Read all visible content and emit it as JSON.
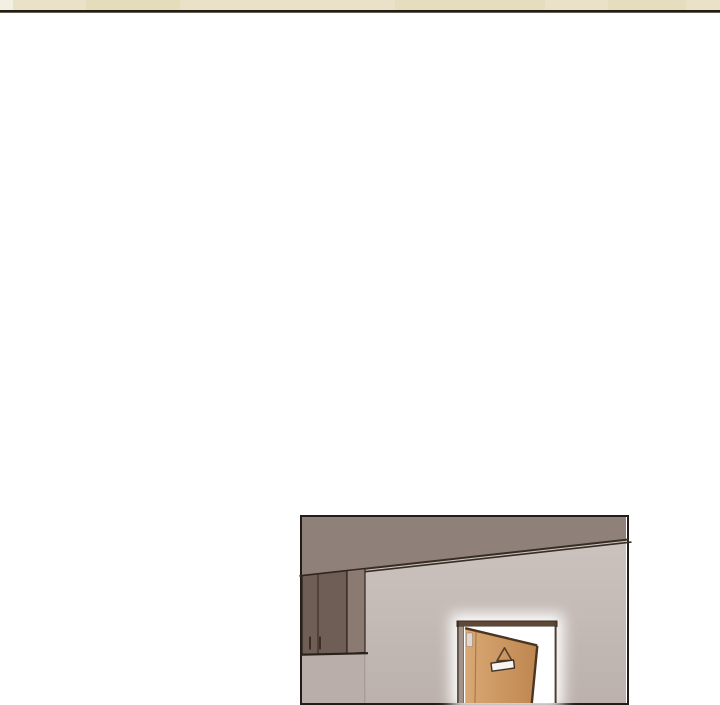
{
  "page": {
    "background": "#ffffff"
  },
  "top_strip": {
    "cream": "#e9e2c8",
    "cream_light": "#f2efe3",
    "beige_patch": "#e2d7b2",
    "edge_line": "#241b11"
  },
  "panel": {
    "border": "#231c18",
    "wall_top": "#cdc5c1",
    "wall_bottom": "#bcb1ac",
    "side_wall": "#b9aeaa",
    "ceiling": "#8f807a",
    "trim_line": "#382d24",
    "corner_line": "#a2958f"
  },
  "cabinet": {
    "front": "#6f5e56",
    "side": "#8b7a71",
    "edge": "#30261f",
    "divider": "#3c3029",
    "handle": "#3a2d24",
    "bottom_line": "#2a211c"
  },
  "doorway": {
    "glow": "#ffffff",
    "opening": "#ffffff",
    "frame_bar": "#5e4937",
    "frame_edge": "#3b2d22",
    "jamb_face": "#a29288",
    "right_frame": "#4f3e31",
    "door_light": "#d9a873",
    "door_dark": "#bf8650",
    "door_edge_line": "#4b351f",
    "stile_line": "#7a5633",
    "hinge": "#ded7d3",
    "sign_hanger": "#54402c",
    "sign_outline": "#3f3026",
    "sign_plate": "#f8f5f1"
  }
}
